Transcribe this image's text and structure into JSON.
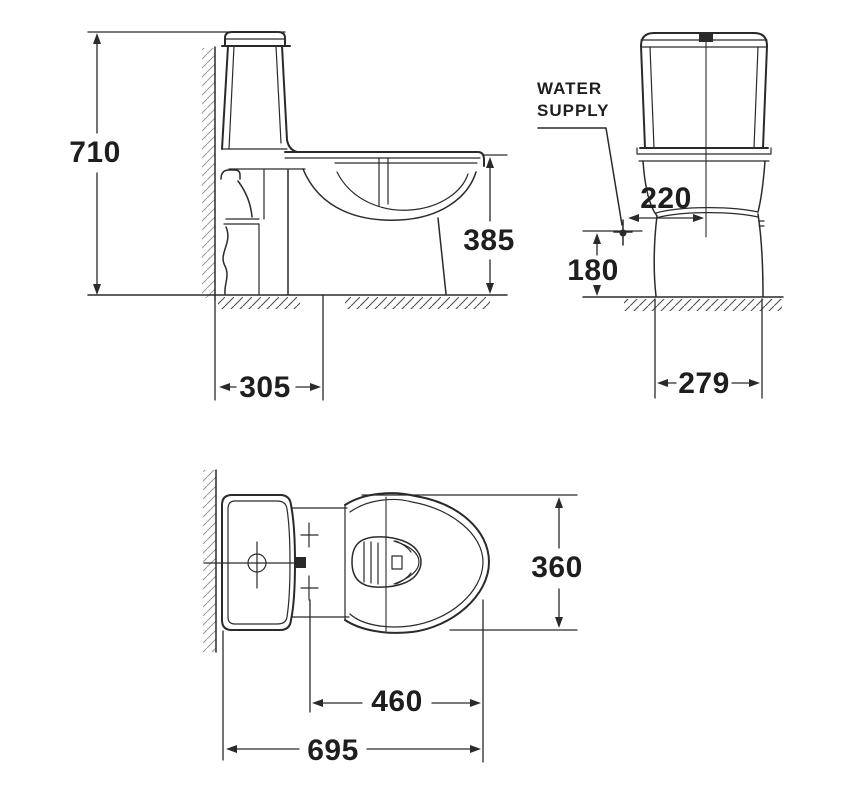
{
  "colors": {
    "background": "#ffffff",
    "line": "#2a2a2a",
    "text": "#1e1e1e"
  },
  "views": {
    "side": {
      "dims": {
        "overall_height": "710",
        "rim_height": "385",
        "outlet_offset": "305"
      }
    },
    "front": {
      "annotation": {
        "line1": "WATER",
        "line2": "SUPPLY"
      },
      "dims": {
        "supply_to_centerline": "220",
        "supply_height": "180",
        "base_width": "279"
      }
    },
    "top": {
      "dims": {
        "bowl_width": "360",
        "bolt_to_front": "460",
        "overall_depth": "695"
      }
    }
  }
}
